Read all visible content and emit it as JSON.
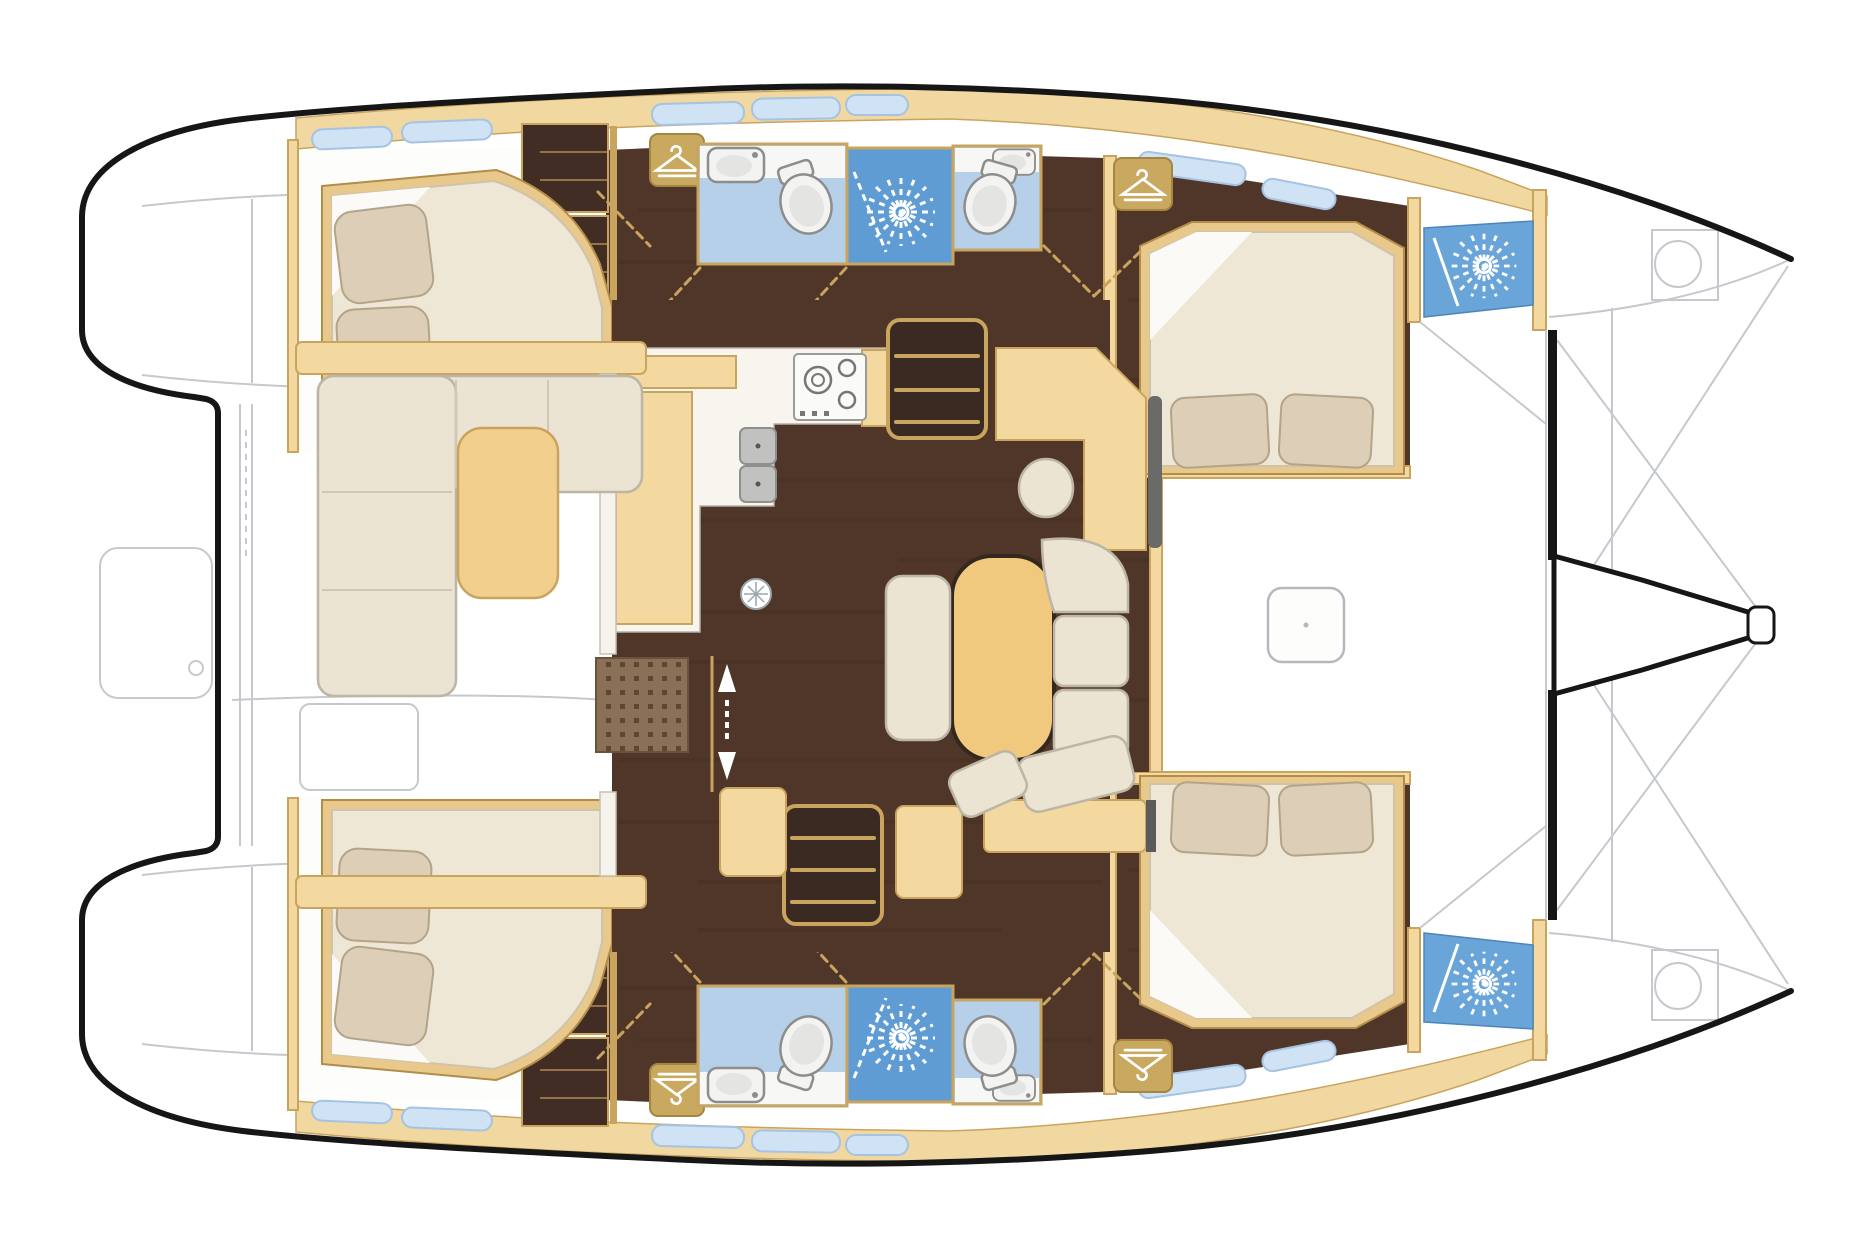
{
  "canvas": {
    "width": 1849,
    "height": 1250
  },
  "palette": {
    "bg": "#ffffff",
    "outline": "#161616",
    "sketch": "#c5c9cd",
    "floor": "#503628",
    "floorStreak": "#2d1d13",
    "wardrobe": "#412d24",
    "wood": "#c9a45e",
    "woodDark": "#a9823d",
    "band": "#f1d8a1",
    "panel": "#f3d99f",
    "tableWood": "#f0c87e",
    "counter": "#f8f5ee",
    "cream": "#ece4d2",
    "creamEdge": "#bdb5a5",
    "mattress": "#efe7d5",
    "mattressEdge": "#cfc3ab",
    "pillow": "#dcceb7",
    "pillowEdge": "#b3a489",
    "sheet": "#fbfaf7",
    "bathFloor": "#b7d0e9",
    "bathWall": "#f7f7f5",
    "shower": "#5f9cd3",
    "showerFwd": "#6aa5da",
    "windowGlass": "#cfe3f5",
    "windowEdge": "#a6c3e2",
    "fixture": "#f3f3f1",
    "fixtureEdge": "#8d8d8b",
    "steel": "#c1c1bf",
    "grayBack": "#6a6a68",
    "matBase": "#8a7057",
    "matDot": "#5c4733",
    "cabinWhite": "#fdfdfc",
    "stairWell": "#3a2a22",
    "lockerFill": "#c9a85f",
    "lockerEdge": "#a5853f"
  },
  "icons": [
    {
      "name": "shower-jet-icon",
      "glyph": "starburst"
    },
    {
      "name": "hanging-locker-icon",
      "glyph": "clothes-hanger"
    },
    {
      "name": "stove-burners-icon",
      "glyph": "burner-rings"
    },
    {
      "name": "companionway-arrows-icon",
      "glyph": "up-down-arrows"
    }
  ],
  "regions": [
    "port-hull-interior",
    "starboard-hull-interior",
    "aft-cabin",
    "forward-cabin",
    "head-compartment",
    "shower-compartment",
    "forepeak-shower",
    "salon",
    "galley",
    "chart-table",
    "cockpit",
    "foredeck",
    "trampoline",
    "stern-platforms"
  ]
}
